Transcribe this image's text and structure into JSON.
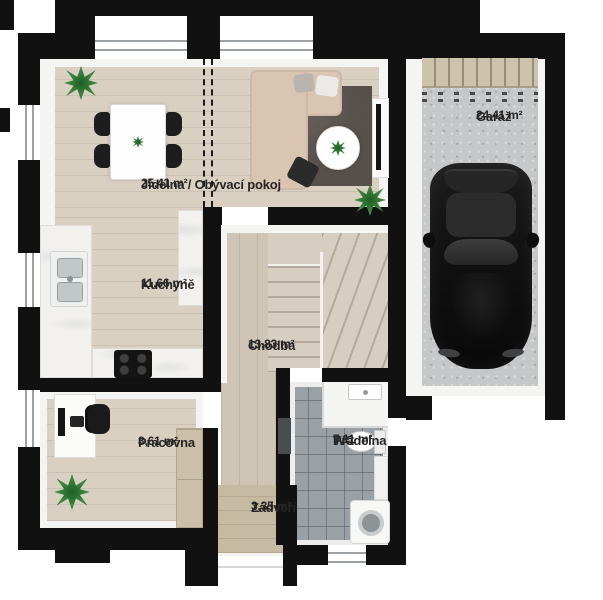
{
  "plan": {
    "rooms": {
      "dining_living": {
        "name": "Jídelna / Obývací pokoj",
        "area": "25,41 m²"
      },
      "kitchen": {
        "name": "Kuchyně",
        "area": "11,66 m²"
      },
      "garage": {
        "name": "Garáž",
        "area": "24,41 m²"
      },
      "hallway": {
        "name": "Chodba",
        "area": "13,83 m²"
      },
      "study": {
        "name": "Pracovna",
        "area": "8,61 m²"
      },
      "wc_laundry": {
        "line1": "WC",
        "line2": "Prádelna",
        "area": "7,11 m²"
      },
      "entry": {
        "name": "Zádveří",
        "area": "3,35 m²"
      }
    },
    "colors": {
      "wall": "#111111",
      "wood_living": "#d9d0c2",
      "wood_hall": "#cec5b6",
      "wood_entry": "#c7baa3",
      "tile_wc": "#9aa1a6",
      "concrete_garage": "#c6c7c9",
      "counter": "#f2f1ee",
      "sofa": "#d9c5b2",
      "rug": "#57504a",
      "plant": "#3c8a3f",
      "car": "#121212",
      "garage_door": "#cdc2ac",
      "label_text": "#262626"
    }
  }
}
